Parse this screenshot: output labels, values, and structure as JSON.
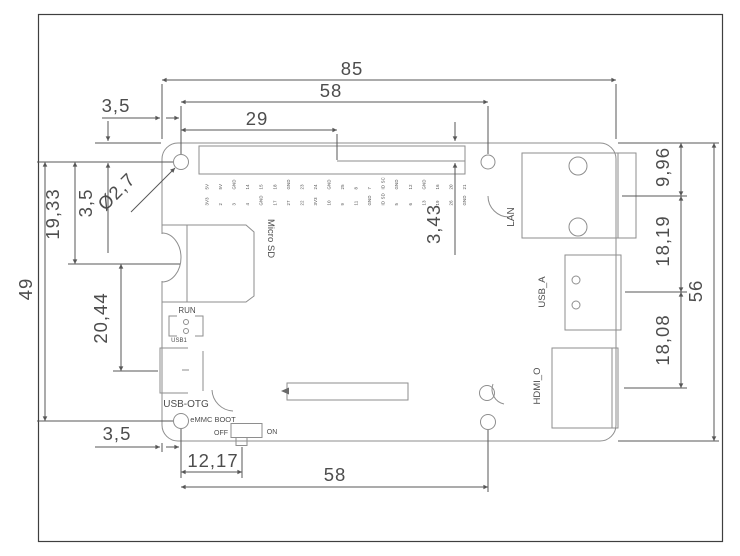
{
  "drawing": {
    "title_hint": "PCB mechanical dimension drawing (single board computer, bottom-left origin)",
    "dims": {
      "overall_width": "85",
      "top_header_width": "58",
      "header_offset": "29",
      "hole_inset_x_top": "3,5",
      "hole_inset_y_left": "3,5",
      "hole_diameter": "Ø2,7",
      "left_height_upper": "19,33",
      "holes_vertical_span": "49",
      "left_height_lower": "20,44",
      "hole_inset_bottom": "3,5",
      "switch_offset": "12,17",
      "bottom_holes_width": "58",
      "header_top_inset": "3,43",
      "lan_center_from_top": "9,96",
      "usb_center_spacing": "18,19",
      "board_height": "56",
      "hdmi_center_spacing": "18,08"
    },
    "labels": {
      "micro_sd": "Micro SD",
      "run": "RUN",
      "usb1": "USB1",
      "usb_otg": "USB-OTG",
      "emmc_boot": "eMMC BOOT",
      "off": "OFF",
      "on": "ON",
      "lan": "LAN",
      "usb_a": "USB_A",
      "hdmi": "HDMI_O"
    },
    "gpio": {
      "columns": [
        {
          "bottom": "3V3",
          "top": "5V"
        },
        {
          "bottom": "2",
          "top": "5V"
        },
        {
          "bottom": "3",
          "top": "GND"
        },
        {
          "bottom": "4",
          "top": "14"
        },
        {
          "bottom": "GND",
          "top": "15"
        },
        {
          "bottom": "17",
          "top": "18"
        },
        {
          "bottom": "27",
          "top": "GND"
        },
        {
          "bottom": "22",
          "top": "23"
        },
        {
          "bottom": "3V3",
          "top": "24"
        },
        {
          "bottom": "10",
          "top": "GND"
        },
        {
          "bottom": "9",
          "top": "25"
        },
        {
          "bottom": "11",
          "top": "8"
        },
        {
          "bottom": "GND",
          "top": "7"
        },
        {
          "bottom": "ID SD",
          "top": "ID SC"
        },
        {
          "bottom": "5",
          "top": "GND"
        },
        {
          "bottom": "6",
          "top": "12"
        },
        {
          "bottom": "13",
          "top": "GND"
        },
        {
          "bottom": "19",
          "top": "16"
        },
        {
          "bottom": "26",
          "top": "20"
        },
        {
          "bottom": "GND",
          "top": "21"
        }
      ]
    },
    "colors": {
      "border": "#3f3f3f",
      "object_lines": "#8e8e8e",
      "dimension_lines": "#575757",
      "text": "#4d4d4d",
      "background": "#ffffff"
    }
  }
}
